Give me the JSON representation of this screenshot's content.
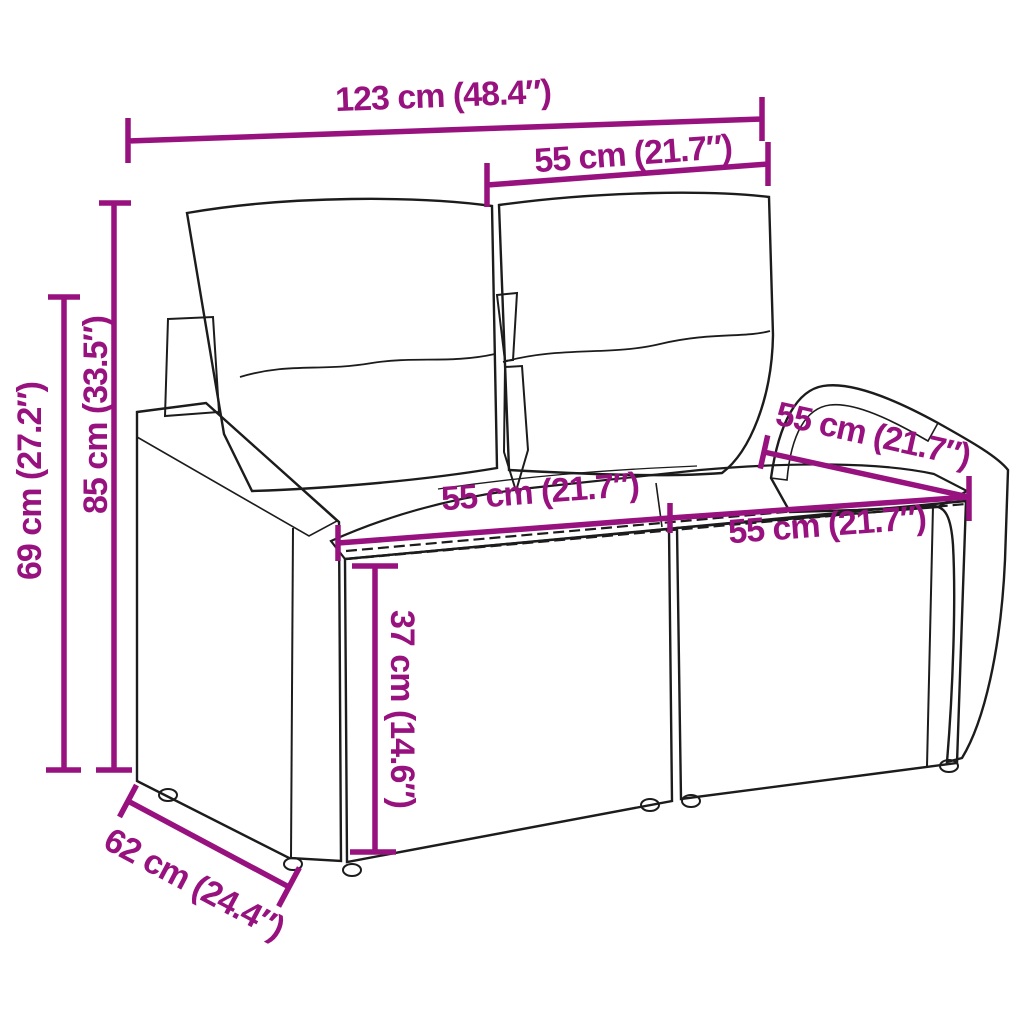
{
  "colors": {
    "dimension_accent": "#98127f",
    "line_art": "#1c1c1c",
    "background": "#ffffff",
    "cushion_fill": "#ffffff"
  },
  "diagram": {
    "type": "product-dimension-diagram",
    "subject": "two-seater poly-rattan garden sofa with back and seat cushions",
    "dimensions": [
      {
        "name": "overall-width",
        "label": "123 cm (48.4″)",
        "cm": 123,
        "inches": 48.4
      },
      {
        "name": "backrest-section-width",
        "label": "55 cm (21.7″)",
        "cm": 55,
        "inches": 21.7
      },
      {
        "name": "overall-height",
        "label": "85 cm (33.5″)",
        "cm": 85,
        "inches": 33.5
      },
      {
        "name": "armrest-height",
        "label": "69 cm (27.2″)",
        "cm": 69,
        "inches": 27.2
      },
      {
        "name": "armrest-depth",
        "label": "55 cm (21.7″)",
        "cm": 55,
        "inches": 21.7
      },
      {
        "name": "seat-width-left",
        "label": "55 cm (21.7″)",
        "cm": 55,
        "inches": 21.7
      },
      {
        "name": "seat-width-right",
        "label": "55 cm (21.7″)",
        "cm": 55,
        "inches": 21.7
      },
      {
        "name": "seat-height",
        "label": "37 cm (14.6″)",
        "cm": 37,
        "inches": 14.6
      },
      {
        "name": "overall-depth",
        "label": "62 cm (24.4″)",
        "cm": 62,
        "inches": 24.4
      }
    ]
  }
}
